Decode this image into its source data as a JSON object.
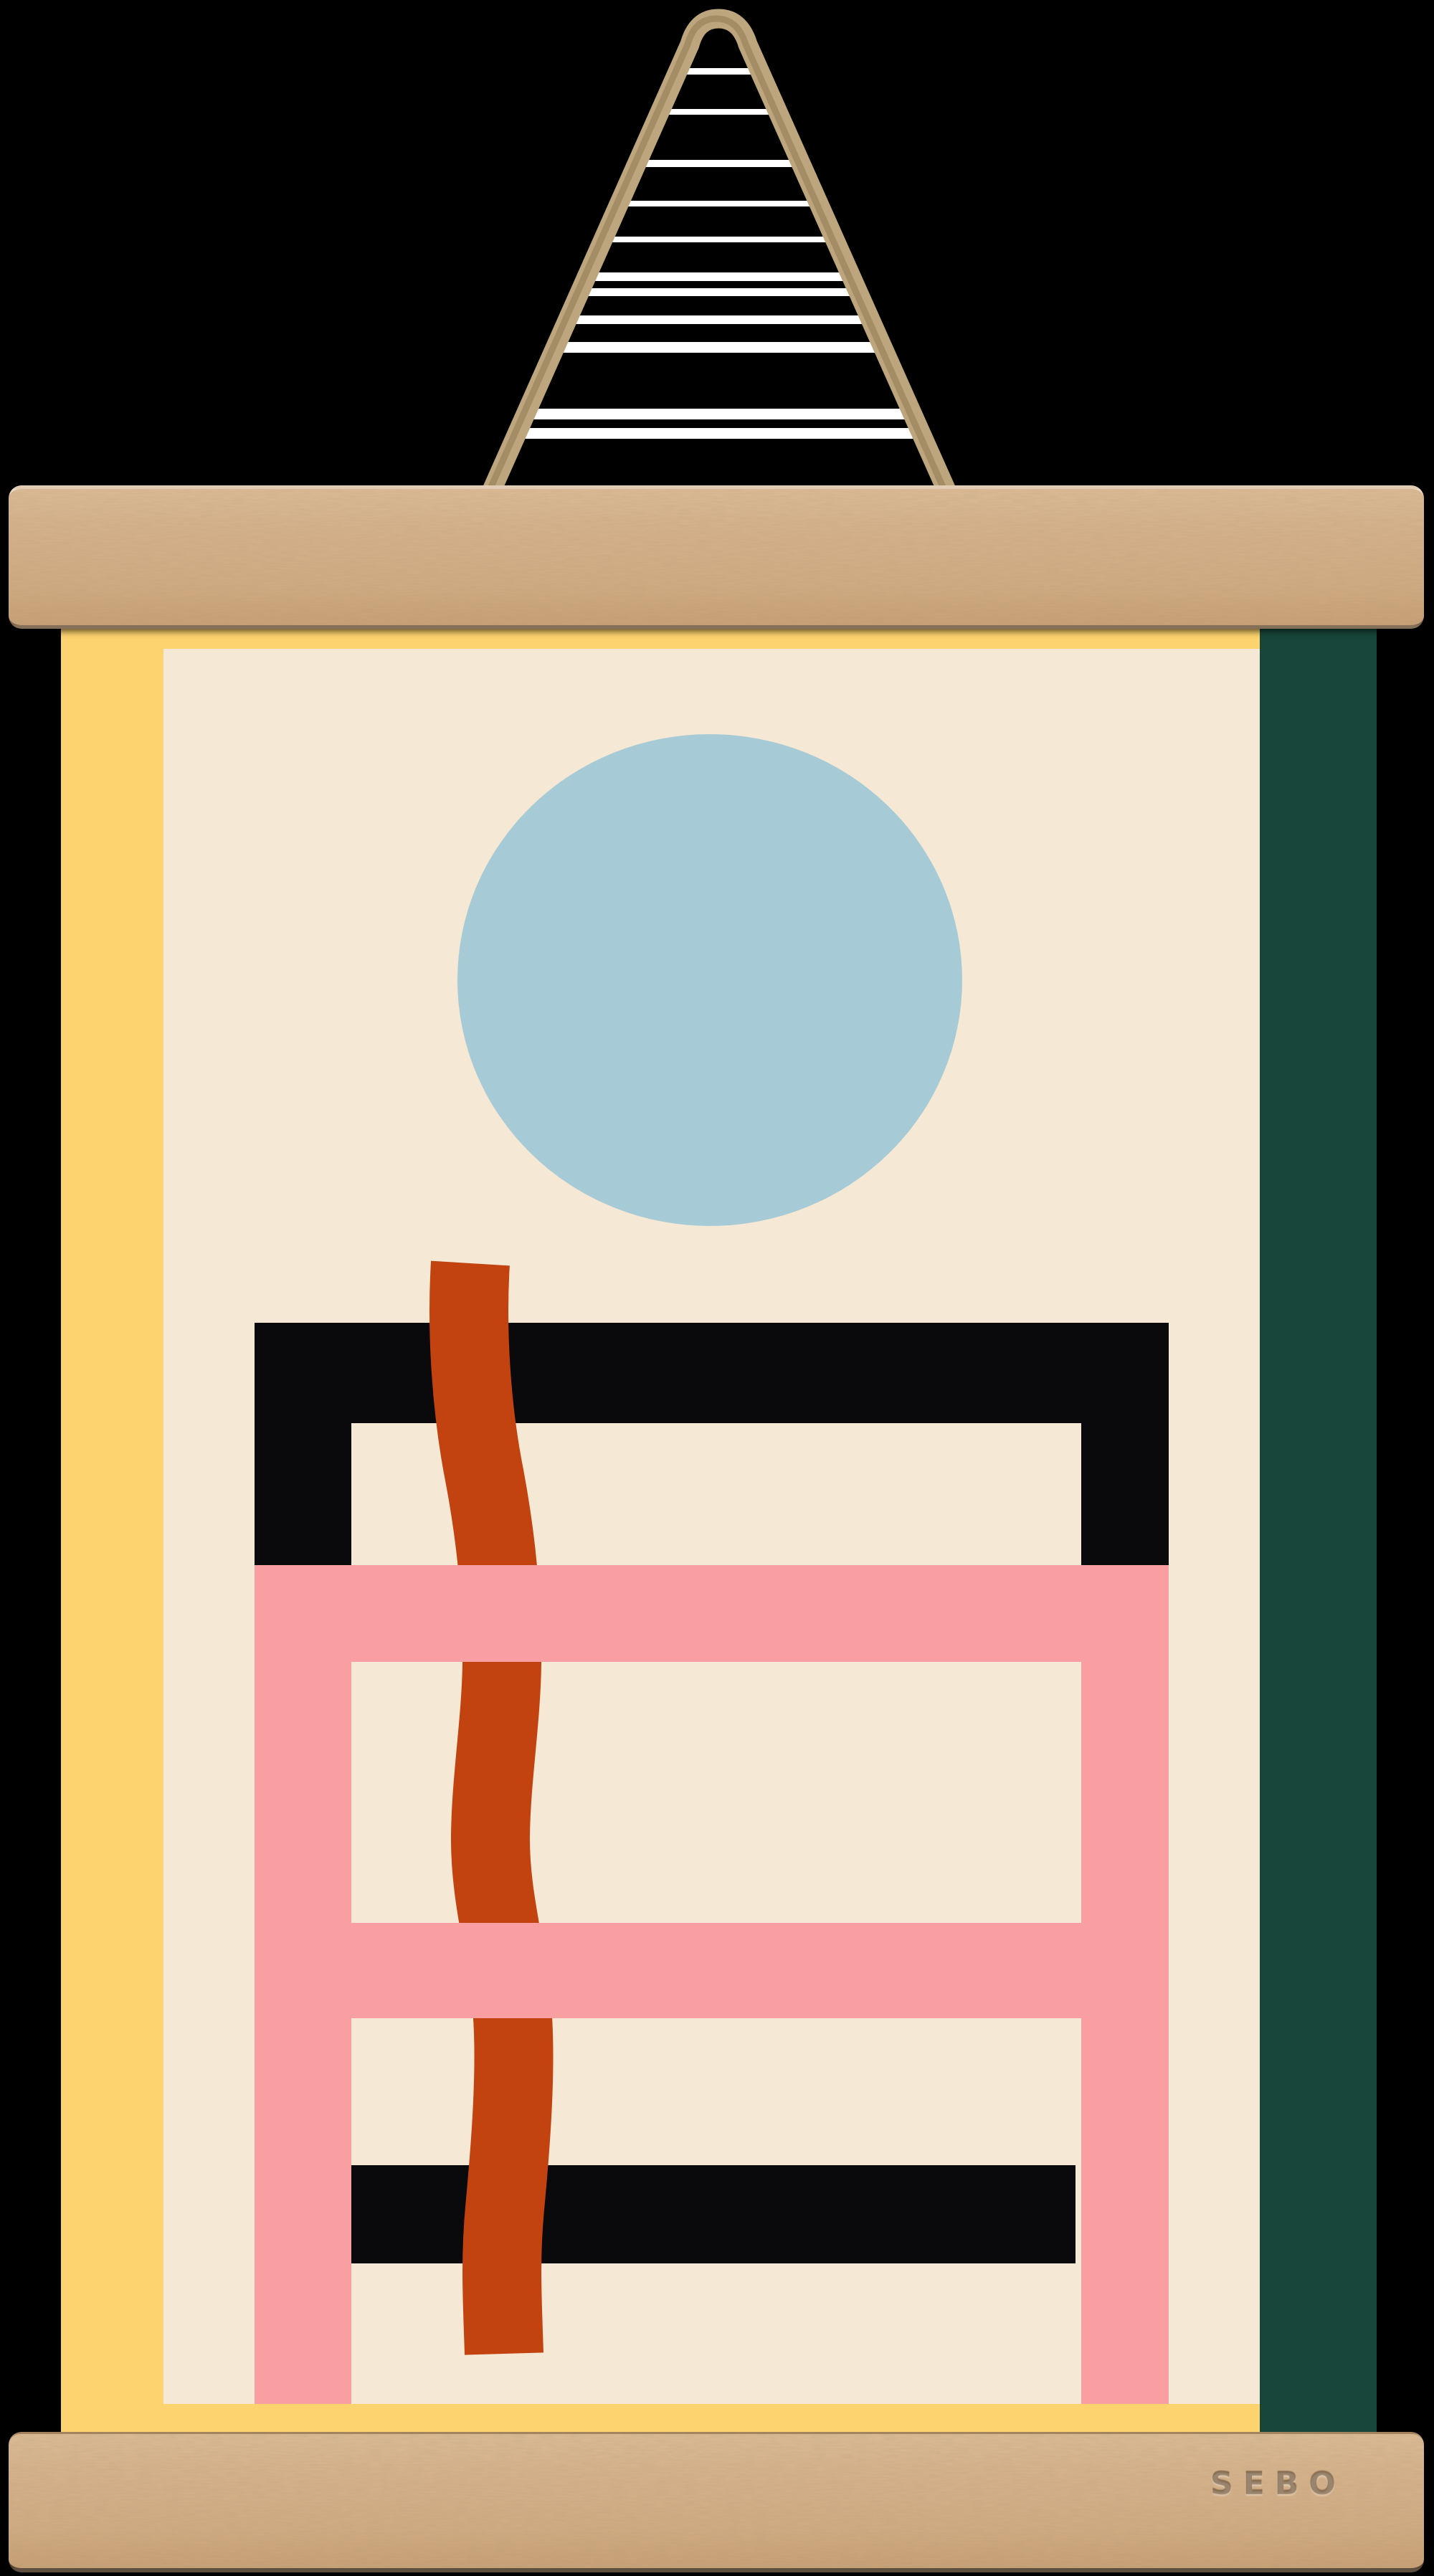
{
  "hanger": {
    "brand_label": "SEBO"
  },
  "colors": {
    "background": "#000000",
    "stripe-white": "#ffffff",
    "rope": "#bda67d",
    "rope-shadow": "#8b7450",
    "wood-base": "#d6b28b",
    "wood-grain": "#8a6a48",
    "poster-yellow": "#fcd36e",
    "poster-cream": "#f5e8d4",
    "poster-green": "#17473a",
    "artwork-black": "#0a090b",
    "artwork-pink": "#fa9fa1",
    "artwork-orange": "#c2430f",
    "artwork-blue": "#a7cbd6"
  }
}
